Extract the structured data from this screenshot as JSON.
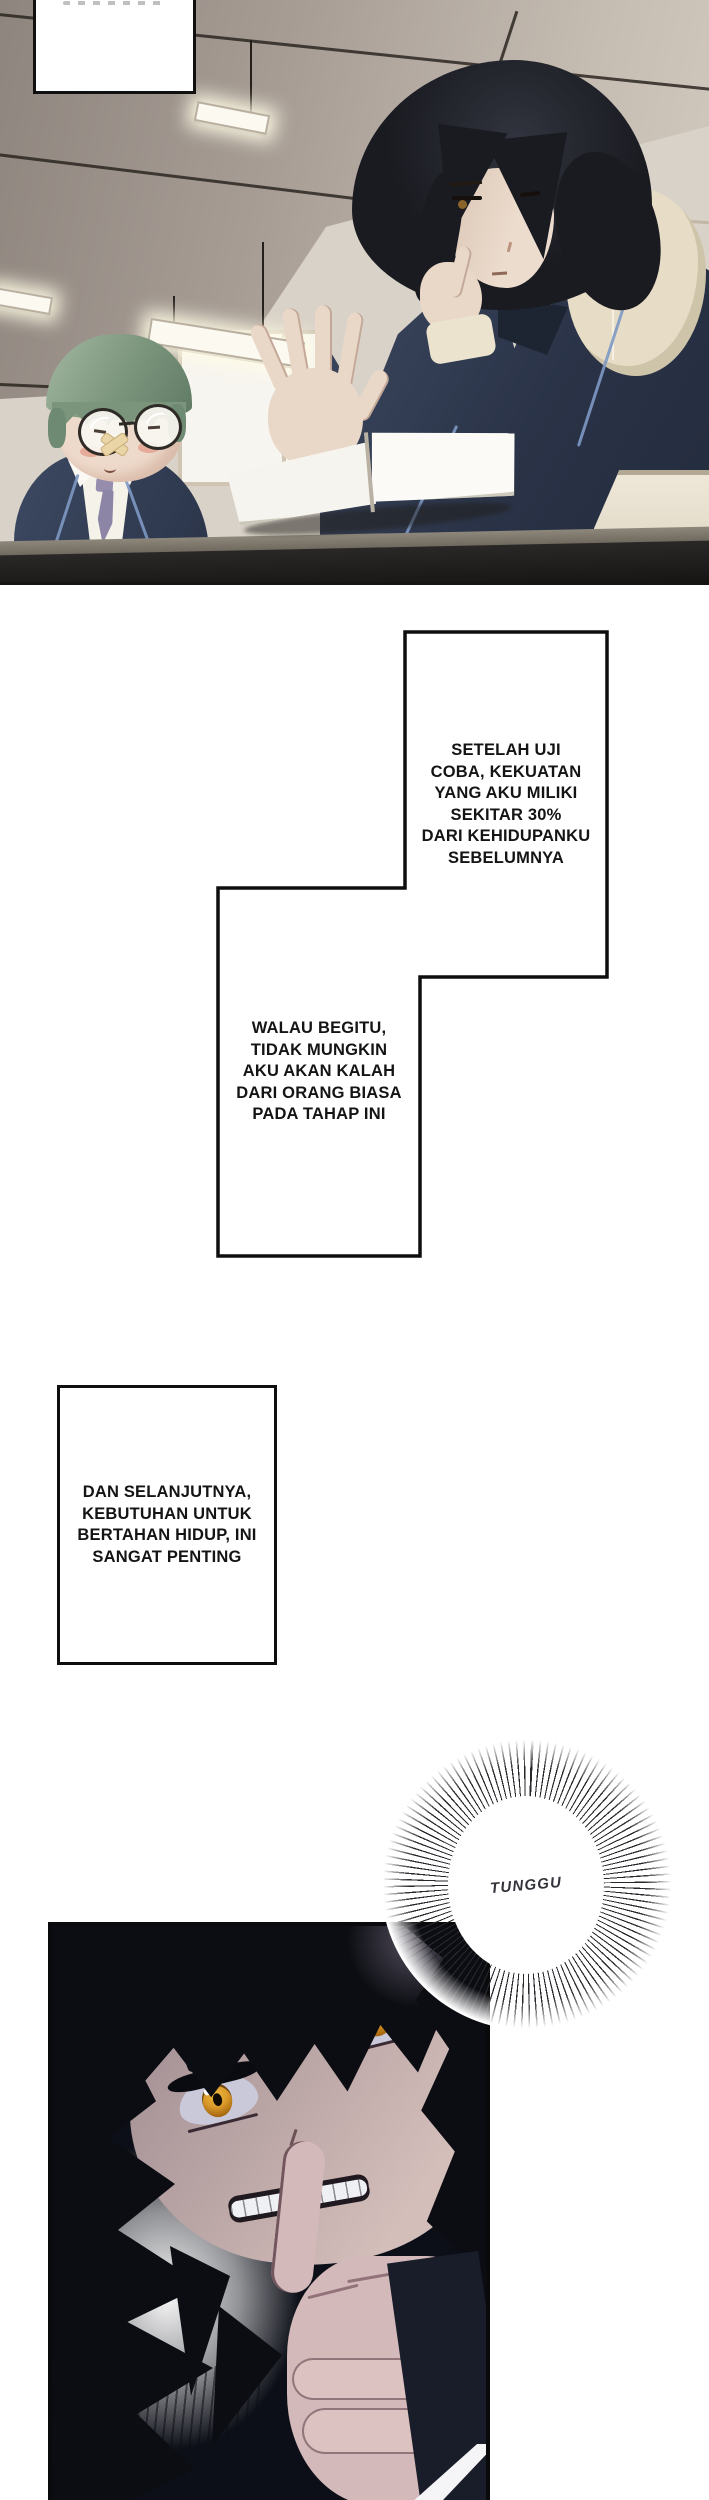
{
  "page": {
    "width": 709,
    "height": 2500,
    "background": "#ffffff"
  },
  "captions": {
    "thought1": {
      "text": "SETELAH UJI\nCOBA, KEKUATAN\nYANG AKU MILIKI\nSEKITAR 30%\nDARI KEHIDUPANKU\nSEBELUMNYA"
    },
    "thought2": {
      "text": "WALAU BEGITU,\nTIDAK MUNGKIN\nAKU AKAN KALAH\nDARI ORANG BIASA\nPADA TAHAP INI"
    },
    "thought3": {
      "text": "DAN SELANJUTNYA,\nKEBUTUHAN UNTUK\nBERTAHAN HIDUP, INI\nSANGAT PENTING"
    },
    "shout": {
      "text": "TUNGGU"
    }
  },
  "colors": {
    "caption_border": "#0e0e0e",
    "eye_amber": "#e0a62e",
    "mc_hair_black": "#1a1b21",
    "mc_blazer_navy": "#2a3347",
    "hoodie_cream": "#e7ddc6",
    "kid_hair_green": "#7b947c",
    "kid_tie_purple": "#8d85a6",
    "dark_panel_bg": "#0d0f18",
    "dark_face_mauve": "#bba6a6",
    "ceiling_gray": "#a79d95",
    "wall_beige": "#d9d2c8"
  }
}
